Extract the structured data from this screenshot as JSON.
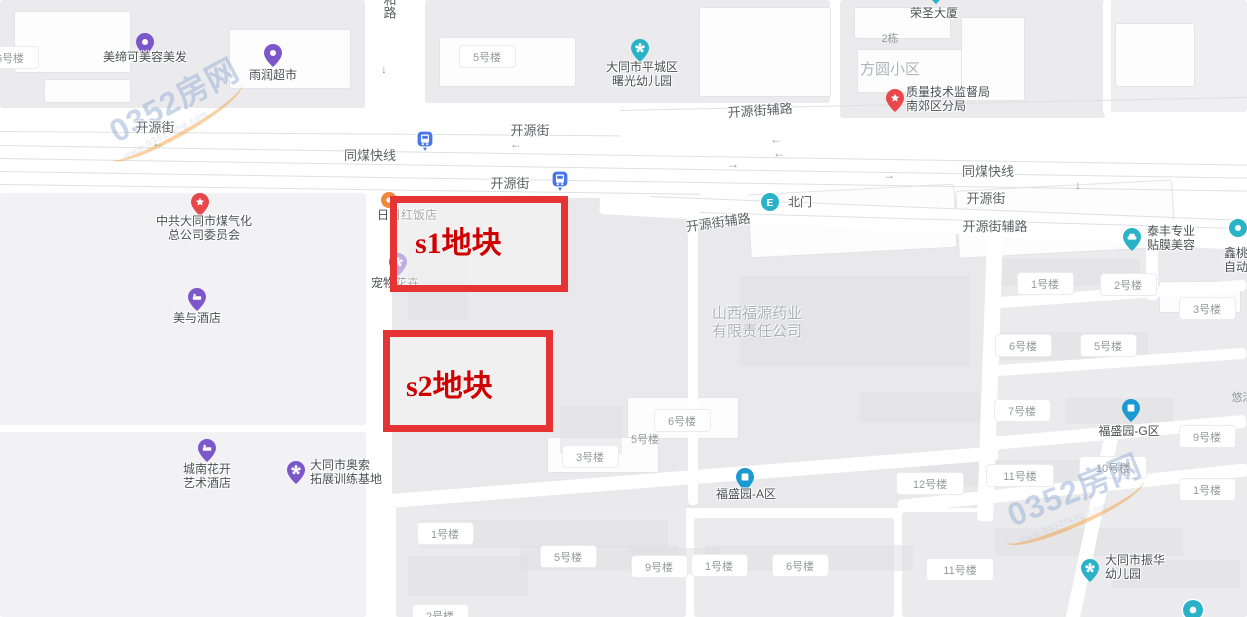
{
  "map": {
    "title": "大同开源街地块位置地图",
    "colors": {
      "purple": "#7b57c9",
      "teal": "#2ab3c6",
      "red": "#e8474b",
      "blue": "#1b9ad2",
      "busBlue": "#4877e8",
      "orange": "#f0873a",
      "parcelBorder": "#e63434",
      "parcelText": "#d00000"
    },
    "parcels": [
      {
        "id": "s1",
        "label": "s1地块",
        "x": 390,
        "y": 196,
        "w": 164,
        "h": 82,
        "tx": 415,
        "ty": 218,
        "fontSize": 30
      },
      {
        "id": "s2",
        "label": "s2地块",
        "x": 383,
        "y": 330,
        "w": 156,
        "h": 88,
        "tx": 406,
        "ty": 361,
        "fontSize": 30
      }
    ],
    "pois": [
      {
        "name": "美缔可美容美发",
        "icon": "scissors",
        "shape": "pin",
        "color": "purple",
        "cx": 145,
        "cy": 42,
        "label": {
          "lines": [
            "美缔可美容美发"
          ],
          "x": 145,
          "y": 50,
          "align": "center"
        }
      },
      {
        "name": "雨润超市",
        "icon": "cart",
        "shape": "pin",
        "color": "purple",
        "cx": 273,
        "cy": 53,
        "label": {
          "lines": [
            "雨润超市"
          ],
          "x": 273,
          "y": 68,
          "align": "center"
        }
      },
      {
        "name": "大同市平城区曙光幼儿园",
        "icon": "flower",
        "shape": "pin",
        "color": "teal",
        "cx": 640,
        "cy": 48,
        "label": {
          "lines": [
            "大同市平城区",
            "曙光幼儿园"
          ],
          "x": 642,
          "y": 60,
          "align": "center"
        }
      },
      {
        "name": "荣圣大厦",
        "icon": "building",
        "shape": "pin",
        "color": "teal",
        "cx": 936,
        "cy": -10,
        "label": {
          "lines": [
            "荣圣大厦"
          ],
          "x": 934,
          "y": 6,
          "align": "center"
        }
      },
      {
        "name": "质量技术监督局南郊区分局",
        "icon": "star",
        "shape": "pin",
        "color": "red",
        "cx": 895,
        "cy": 98,
        "label": {
          "lines": [
            "质量技术监督局",
            "南郊区分局"
          ],
          "x": 906,
          "y": 85,
          "align": "left"
        }
      },
      {
        "name": "中共大同市煤气化总公司委员会",
        "icon": "star",
        "shape": "pin",
        "color": "red",
        "cx": 200,
        "cy": 202,
        "label": {
          "lines": [
            "中共大同市煤气化",
            "总公司委员会"
          ],
          "x": 204,
          "y": 214,
          "align": "center"
        }
      },
      {
        "name": "日日红饭店",
        "icon": "dot",
        "shape": "circle",
        "color": "orange",
        "cx": 389,
        "cy": 200,
        "r": 8,
        "label": {
          "lines": [
            "日日红饭店"
          ],
          "x": 407,
          "y": 208,
          "align": "center"
        }
      },
      {
        "name": "宠物花卉",
        "icon": "flower",
        "shape": "pin",
        "color": "purple",
        "cx": 398,
        "cy": 262,
        "label": {
          "lines": [
            "宠物花卉"
          ],
          "x": 395,
          "y": 276,
          "align": "center"
        }
      },
      {
        "name": "美与酒店",
        "icon": "bed",
        "shape": "pin",
        "color": "purple",
        "cx": 197,
        "cy": 297,
        "label": {
          "lines": [
            "美与酒店"
          ],
          "x": 197,
          "y": 311,
          "align": "center"
        }
      },
      {
        "name": "城南花开艺术酒店",
        "icon": "bed",
        "shape": "pin",
        "color": "purple",
        "cx": 207,
        "cy": 448,
        "label": {
          "lines": [
            "城南花开",
            "艺术酒店"
          ],
          "x": 207,
          "y": 462,
          "align": "center"
        }
      },
      {
        "name": "大同市奥索拓展训练基地",
        "icon": "flower",
        "shape": "pin",
        "color": "purple",
        "cx": 296,
        "cy": 470,
        "label": {
          "lines": [
            "大同市奥索",
            "拓展训练基地"
          ],
          "x": 310,
          "y": 458,
          "align": "left"
        }
      },
      {
        "name": "北门",
        "icon": "gate",
        "shape": "circle",
        "color": "teal",
        "cx": 770,
        "cy": 202,
        "r": 9,
        "label": {
          "lines": [
            "北门"
          ],
          "x": 788,
          "y": 195,
          "align": "left"
        }
      },
      {
        "name": "泰丰专业贴膜美容",
        "icon": "car",
        "shape": "pin",
        "color": "teal",
        "cx": 1132,
        "cy": 237,
        "label": {
          "lines": [
            "泰丰专业",
            "贴膜美容"
          ],
          "x": 1147,
          "y": 224,
          "align": "left"
        }
      },
      {
        "name": "鑫桃园自动变速箱",
        "icon": "dot",
        "shape": "circle",
        "color": "teal",
        "cx": 1238,
        "cy": 228,
        "r": 9,
        "label": {
          "lines": [
            "鑫桃园",
            "自动变"
          ],
          "x": 1224,
          "y": 246,
          "align": "left"
        }
      },
      {
        "name": "福盛园-A区",
        "icon": "building",
        "shape": "pin",
        "color": "blue",
        "cx": 745,
        "cy": 477,
        "label": {
          "lines": [
            "福盛园-A区"
          ],
          "x": 746,
          "y": 487,
          "align": "center"
        }
      },
      {
        "name": "福盛园-G区",
        "icon": "building",
        "shape": "pin",
        "color": "blue",
        "cx": 1131,
        "cy": 408,
        "label": {
          "lines": [
            "福盛园-G区"
          ],
          "x": 1129,
          "y": 424,
          "align": "center"
        }
      },
      {
        "name": "大同市振华幼儿园",
        "icon": "flower",
        "shape": "pin",
        "color": "teal",
        "cx": 1090,
        "cy": 568,
        "label": {
          "lines": [
            "大同市振华",
            "幼儿园"
          ],
          "x": 1105,
          "y": 553,
          "align": "left"
        }
      },
      {
        "name": "公交站-开源街北",
        "icon": "bus",
        "shape": "bus",
        "color": "busBlue",
        "cx": 425,
        "cy": 139,
        "label": {
          "lines": [],
          "x": 0,
          "y": 0,
          "align": "center"
        }
      },
      {
        "name": "公交站-开源街南",
        "icon": "bus",
        "shape": "bus",
        "color": "busBlue",
        "cx": 560,
        "cy": 179,
        "label": {
          "lines": [],
          "x": 0,
          "y": 0,
          "align": "center"
        }
      },
      {
        "name": "未命名地点",
        "icon": "dot",
        "shape": "circle",
        "color": "teal",
        "cx": 1193,
        "cy": 610,
        "r": 10,
        "label": {
          "lines": [],
          "x": 0,
          "y": 0,
          "align": "center"
        }
      }
    ],
    "road_labels": [
      {
        "text": "开源街",
        "x": 155,
        "y": 117,
        "rot": 0
      },
      {
        "text": "同煤快线",
        "x": 370,
        "y": 145,
        "rot": 0
      },
      {
        "text": "开源街",
        "x": 530,
        "y": 120,
        "rot": 0
      },
      {
        "text": "开源街辅路",
        "x": 760,
        "y": 100,
        "rot": -4
      },
      {
        "text": "同煤快线",
        "x": 988,
        "y": 161,
        "rot": 0
      },
      {
        "text": "开源街",
        "x": 986,
        "y": 188,
        "rot": 0
      },
      {
        "text": "开源街",
        "x": 510,
        "y": 173,
        "rot": 0
      },
      {
        "text": "开源街辅路",
        "x": 718,
        "y": 212,
        "rot": -8
      },
      {
        "text": "开源街辅路",
        "x": 995,
        "y": 216,
        "rot": 0
      },
      {
        "text": "和路",
        "x": 389,
        "y": -7,
        "rot": 0,
        "vertical": true
      }
    ],
    "building_labels": [
      {
        "text": "6号楼",
        "x": 10,
        "y": 58,
        "pill": true
      },
      {
        "text": "5号楼",
        "x": 487,
        "y": 57,
        "pill": true
      },
      {
        "text": "2栋",
        "x": 890,
        "y": 38,
        "pill": false
      },
      {
        "text": "1号楼",
        "x": 1045,
        "y": 284,
        "pill": true
      },
      {
        "text": "2号楼",
        "x": 1128,
        "y": 285,
        "pill": true
      },
      {
        "text": "3号楼",
        "x": 1207,
        "y": 309,
        "pill": true
      },
      {
        "text": "6号楼",
        "x": 1023,
        "y": 346,
        "pill": true
      },
      {
        "text": "5号楼",
        "x": 1108,
        "y": 346,
        "pill": true
      },
      {
        "text": "7号楼",
        "x": 1022,
        "y": 411,
        "pill": true
      },
      {
        "text": "9号楼",
        "x": 1207,
        "y": 437,
        "pill": true
      },
      {
        "text": "悠活城",
        "x": 1248,
        "y": 397,
        "pill": false
      },
      {
        "text": "6号楼",
        "x": 682,
        "y": 421,
        "pill": true
      },
      {
        "text": "5号楼",
        "x": 645,
        "y": 439,
        "pill": false
      },
      {
        "text": "3号楼",
        "x": 590,
        "y": 457,
        "pill": true
      },
      {
        "text": "12号楼",
        "x": 930,
        "y": 484,
        "pill": true
      },
      {
        "text": "11号楼",
        "x": 1020,
        "y": 476,
        "pill": true
      },
      {
        "text": "10号楼",
        "x": 1113,
        "y": 468,
        "pill": true
      },
      {
        "text": "1号楼",
        "x": 1207,
        "y": 490,
        "pill": true
      },
      {
        "text": "1号楼",
        "x": 445,
        "y": 534,
        "pill": true
      },
      {
        "text": "5号楼",
        "x": 568,
        "y": 557,
        "pill": true
      },
      {
        "text": "9号楼",
        "x": 659,
        "y": 567,
        "pill": true
      },
      {
        "text": "1号楼",
        "x": 719,
        "y": 566,
        "pill": true
      },
      {
        "text": "6号楼",
        "x": 800,
        "y": 566,
        "pill": true
      },
      {
        "text": "11号楼",
        "x": 960,
        "y": 570,
        "pill": true
      },
      {
        "text": "2号楼",
        "x": 440,
        "y": 616,
        "pill": true
      }
    ],
    "area_labels": [
      {
        "lines": [
          "方圆小区"
        ],
        "x": 890,
        "y": 61,
        "size": 15
      },
      {
        "lines": [
          "山西福源药业",
          "有限责任公司"
        ],
        "x": 757,
        "y": 305,
        "size": 15
      }
    ],
    "arrows": [
      {
        "ch": "←",
        "x": 152,
        "y": 136
      },
      {
        "ch": "←",
        "x": 510,
        "y": 137
      },
      {
        "ch": "←",
        "x": 770,
        "y": 132
      },
      {
        "ch": "←",
        "x": 773,
        "y": 146
      },
      {
        "ch": "→",
        "x": 727,
        "y": 157
      },
      {
        "ch": "→",
        "x": 883,
        "y": 168
      },
      {
        "ch": "↓",
        "x": 381,
        "y": 62
      },
      {
        "ch": "↓",
        "x": 1075,
        "y": 178
      }
    ],
    "watermarks": [
      {
        "text": "0352房网",
        "sub": "www.0352fang.com",
        "x": 105,
        "y": 75,
        "rot": -28
      },
      {
        "text": "0352房网",
        "sub": "www.0352fang.com",
        "x": 1005,
        "y": 465,
        "rot": -22
      }
    ]
  }
}
